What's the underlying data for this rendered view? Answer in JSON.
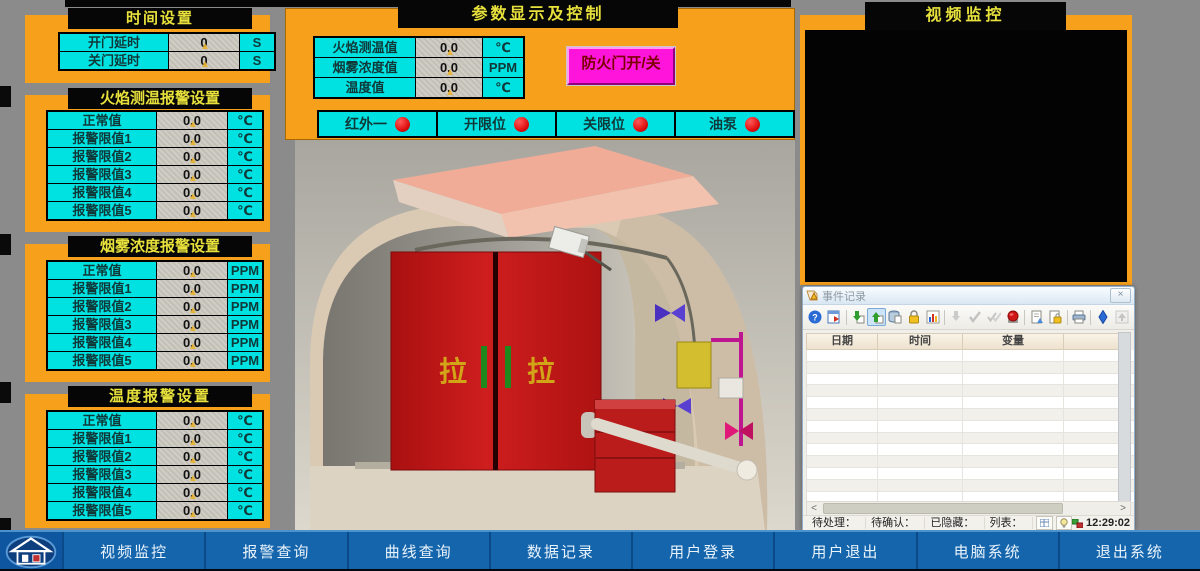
{
  "colors": {
    "orange": "#F6A01C",
    "cyan": "#00E2E2",
    "panel_header_bg": "#060606",
    "panel_header_text": "#E8E13C",
    "value_cell_bg": "#CBC7BF",
    "magenta_button": "#FF14DC",
    "magenta_button_text": "#7A0000",
    "indicator_red": "#E01010",
    "nav_blue": "#1565AC",
    "nav_text": "#EAF4FC",
    "page_bg": "#8B8B8B",
    "door_red": "#C01818"
  },
  "left_panels": [
    {
      "title": "时间设置",
      "rows": [
        {
          "label": "开门延时",
          "value": "0",
          "unit": "S"
        },
        {
          "label": "关门延时",
          "value": "0",
          "unit": "S"
        }
      ]
    },
    {
      "title": "火焰测温报警设置",
      "rows": [
        {
          "label": "正常值",
          "value": "0.0",
          "unit": "℃"
        },
        {
          "label": "报警限值1",
          "value": "0.0",
          "unit": "℃"
        },
        {
          "label": "报警限值2",
          "value": "0.0",
          "unit": "℃"
        },
        {
          "label": "报警限值3",
          "value": "0.0",
          "unit": "℃"
        },
        {
          "label": "报警限值4",
          "value": "0.0",
          "unit": "℃"
        },
        {
          "label": "报警限值5",
          "value": "0.0",
          "unit": "℃"
        }
      ]
    },
    {
      "title": "烟雾浓度报警设置",
      "rows": [
        {
          "label": "正常值",
          "value": "0.0",
          "unit": "PPM"
        },
        {
          "label": "报警限值1",
          "value": "0.0",
          "unit": "PPM"
        },
        {
          "label": "报警限值2",
          "value": "0.0",
          "unit": "PPM"
        },
        {
          "label": "报警限值3",
          "value": "0.0",
          "unit": "PPM"
        },
        {
          "label": "报警限值4",
          "value": "0.0",
          "unit": "PPM"
        },
        {
          "label": "报警限值5",
          "value": "0.0",
          "unit": "PPM"
        }
      ]
    },
    {
      "title": "温度报警设置",
      "rows": [
        {
          "label": "正常值",
          "value": "0.0",
          "unit": "℃"
        },
        {
          "label": "报警限值1",
          "value": "0.0",
          "unit": "℃"
        },
        {
          "label": "报警限值2",
          "value": "0.0",
          "unit": "℃"
        },
        {
          "label": "报警限值3",
          "value": "0.0",
          "unit": "℃"
        },
        {
          "label": "报警限值4",
          "value": "0.0",
          "unit": "℃"
        },
        {
          "label": "报警限值5",
          "value": "0.0",
          "unit": "℃"
        }
      ]
    }
  ],
  "center": {
    "title": "参数显示及控制",
    "params": [
      {
        "label": "火焰测温值",
        "value": "0.0",
        "unit": "℃"
      },
      {
        "label": "烟雾浓度值",
        "value": "0.0",
        "unit": "PPM"
      },
      {
        "label": "温度值",
        "value": "0.0",
        "unit": "℃"
      }
    ],
    "door_button_label": "防火门开/关",
    "indicators": [
      {
        "label": "红外一",
        "state": "red"
      },
      {
        "label": "开限位",
        "state": "red"
      },
      {
        "label": "关限位",
        "state": "red"
      },
      {
        "label": "油泵",
        "state": "red"
      }
    ],
    "scene": {
      "door_label_left": "拉",
      "door_label_right": "拉"
    }
  },
  "video_panel": {
    "title": "视频监控"
  },
  "event_window": {
    "title": "事件记录",
    "close_label": "×",
    "toolbar_icon_names": [
      "help-icon",
      "schedule-icon",
      "export-icon",
      "import-icon",
      "database-icon",
      "lock-icon",
      "chart-icon",
      "acknowledge-icon",
      "confirm-icon",
      "confirm-all-icon",
      "emergency-stop-icon",
      "report-icon",
      "secure-report-icon",
      "print-icon",
      "navigate-icon",
      "scroll-top-icon"
    ],
    "columns": [
      "日期",
      "时间",
      "变量"
    ],
    "row_count": 13,
    "scrollbar": {
      "left_arrow": "<",
      "right_arrow": ">"
    },
    "status": {
      "pending_label": "待处理：0",
      "confirmed_label": "待确认：0",
      "hidden_label": "已隐藏：0",
      "list_label": "列表：0",
      "clock": "12:29:02"
    }
  },
  "nav": {
    "items": [
      {
        "label": "视频监控"
      },
      {
        "label": "报警查询"
      },
      {
        "label": "曲线查询"
      },
      {
        "label": "数据记录"
      },
      {
        "label": "用户登录"
      },
      {
        "label": "用户退出"
      },
      {
        "label": "电脑系统"
      },
      {
        "label": "退出系统"
      }
    ]
  }
}
